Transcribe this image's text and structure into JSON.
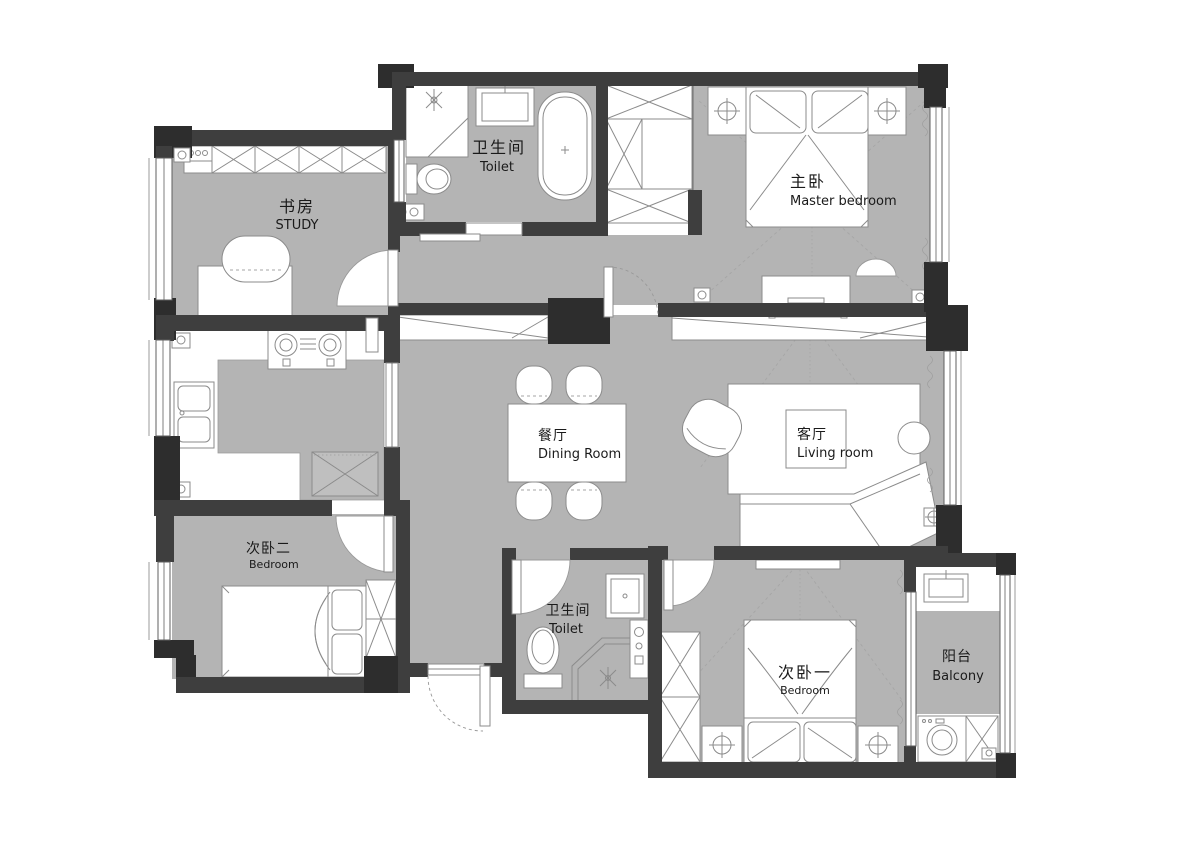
{
  "plan": {
    "type": "apartment-floor-plan",
    "colors": {
      "wall": "#3e3e3e",
      "floor": "#b4b4b4",
      "fixture": "#ffffff",
      "outline": "#8b8b8b",
      "text": "#1a1a1a"
    },
    "rooms": {
      "study": {
        "zh": "书房",
        "en": "STUDY"
      },
      "toilet_top": {
        "zh": "卫生间",
        "en": "Toilet"
      },
      "master_bedroom": {
        "zh": "主卧",
        "en": "Master bedroom"
      },
      "kitchen": {
        "zh": "厨房",
        "en": "Kitchen"
      },
      "dining_room": {
        "zh": "餐厅",
        "en": "Dining Room"
      },
      "living_room": {
        "zh": "客厅",
        "en": "Living room"
      },
      "bedroom_two": {
        "zh": "次卧二",
        "en": "Bedroom"
      },
      "toilet_bottom": {
        "zh": "卫生间",
        "en": "Toilet"
      },
      "bedroom_one": {
        "zh": "次卧一",
        "en": "Bedroom"
      },
      "balcony": {
        "zh": "阳台",
        "en": "Balcony"
      }
    }
  }
}
